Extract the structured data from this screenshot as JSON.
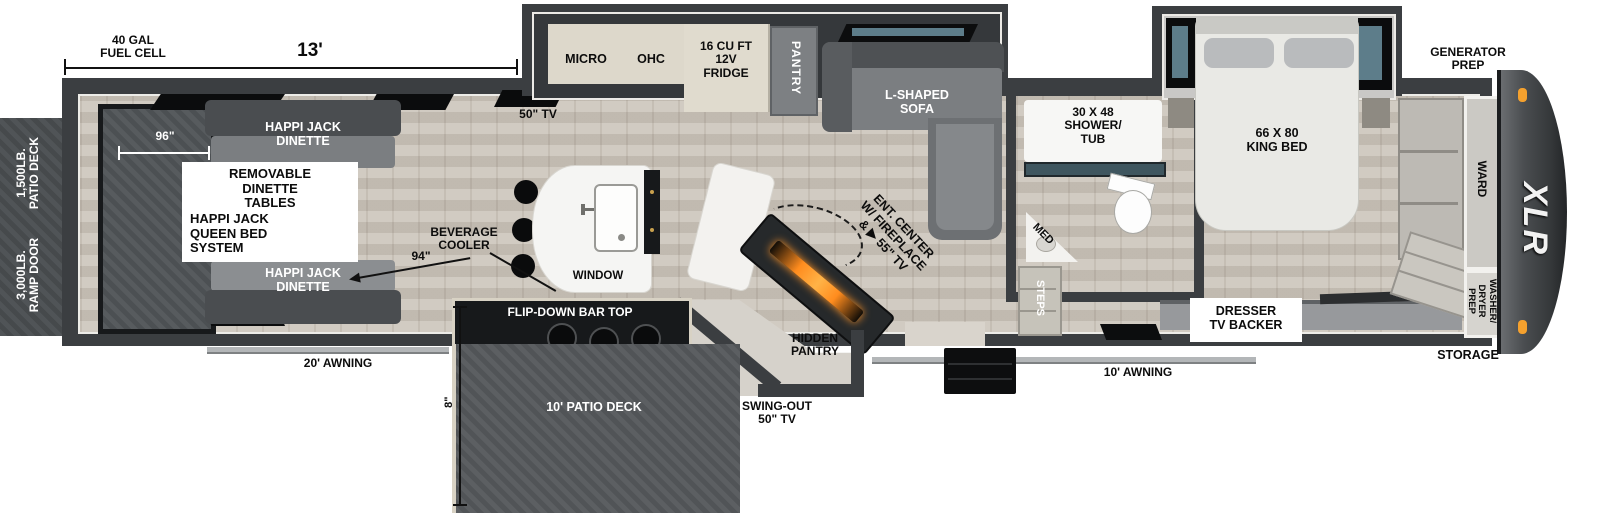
{
  "plan": {
    "logo": "XLR",
    "rear_exterior": {
      "patio_deck_rating": "1,500LB.\nPATIO DECK",
      "ramp_door_rating": "3,000LB.\nRAMP DOOR"
    },
    "dimensions": {
      "fuel_cell": "40 GAL\nFUEL CELL",
      "garage_length": "13'",
      "garage_width": "96\"",
      "garage_span": "94\"",
      "deck_height": "8\""
    },
    "garage": {
      "dinette_top": "HAPPI JACK\nDINETTE",
      "dinette_bottom": "HAPPI JACK\nDINETTE",
      "removable_tables": "REMOVABLE\nDINETTE\nTABLES",
      "queen_bed_system": "HAPPI JACK\nQUEEN BED\nSYSTEM",
      "tv": "50\" TV"
    },
    "kitchen": {
      "micro": "MICRO",
      "ohc": "OHC",
      "fridge": "16 CU FT\n12V\nFRIDGE",
      "pantry": "PANTRY",
      "beverage_cooler": "BEVERAGE\nCOOLER",
      "window": "WINDOW",
      "hidden_pantry": "HIDDEN\nPANTRY"
    },
    "living": {
      "sofa": "L-SHAPED\nSOFA",
      "ent_center": "ENT. CENTER\nW/ FIREPLACE\n& ▶ 55\" TV"
    },
    "bath": {
      "shower": "30 X 48\nSHOWER/\nTUB",
      "med": "MED",
      "steps": "STEPS"
    },
    "bedroom": {
      "king_bed": "66 X 80\nKING BED",
      "dresser": "DRESSER\nTV BACKER",
      "ward": "WARD",
      "washer_dryer": "WASHER/\nDRYER\nPREP"
    },
    "front_exterior": {
      "generator_prep": "GENERATOR\nPREP",
      "storage": "STORAGE"
    },
    "exterior": {
      "awning_left": "20' AWNING",
      "awning_right": "10' AWNING",
      "flip_bar": "FLIP-DOWN BAR TOP",
      "patio_deck": "10' PATIO DECK",
      "swing_tv": "SWING-OUT\n50\" TV"
    }
  }
}
